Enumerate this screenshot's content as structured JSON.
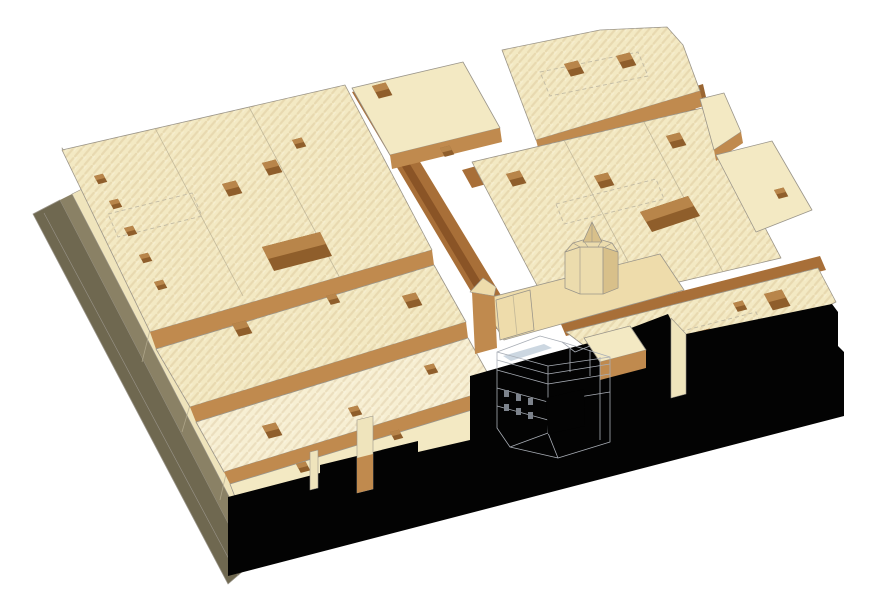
{
  "figure": {
    "kind": "Axonometric architectural massing model of a city block",
    "description": "Bird's-eye axonometric rendering of a dense historic urban block: cream wood-toned building masses pierced by dark courtyard voids, brown street canyons, an octagonal domed structure near the center, a white wireframe infill building with a dark square opening, an olive timber plinth along the left edge and a solid black shadow face across the front of the block."
  },
  "colors": {
    "background": "#ffffff",
    "roof": "#f3e9c3",
    "roof_light": "#f7efd3",
    "roof_warm": "#eedcab",
    "wall": "#c08a4e",
    "wall_dark": "#9a6632",
    "wall_deep": "#7c4e1f",
    "street": "#a86f38",
    "street_dark": "#8a5426",
    "hole_side": "#8f5e2b",
    "hole_lit": "#b8854a",
    "plinth": "#6f6850",
    "plinth_dark": "#57523c",
    "plinth_light": "#8a8165",
    "pavement": "#efe4bc",
    "black": "#030303",
    "outline": "#9a958a",
    "dashed": "#c2bba4",
    "dome": "#ecdcad",
    "dome_dark": "#d8c08a",
    "white_bldg": "#ffffff",
    "white_line": "#a9aeb6",
    "slab_blue": "#ccd7e1",
    "window_dark": "#7d838c"
  }
}
